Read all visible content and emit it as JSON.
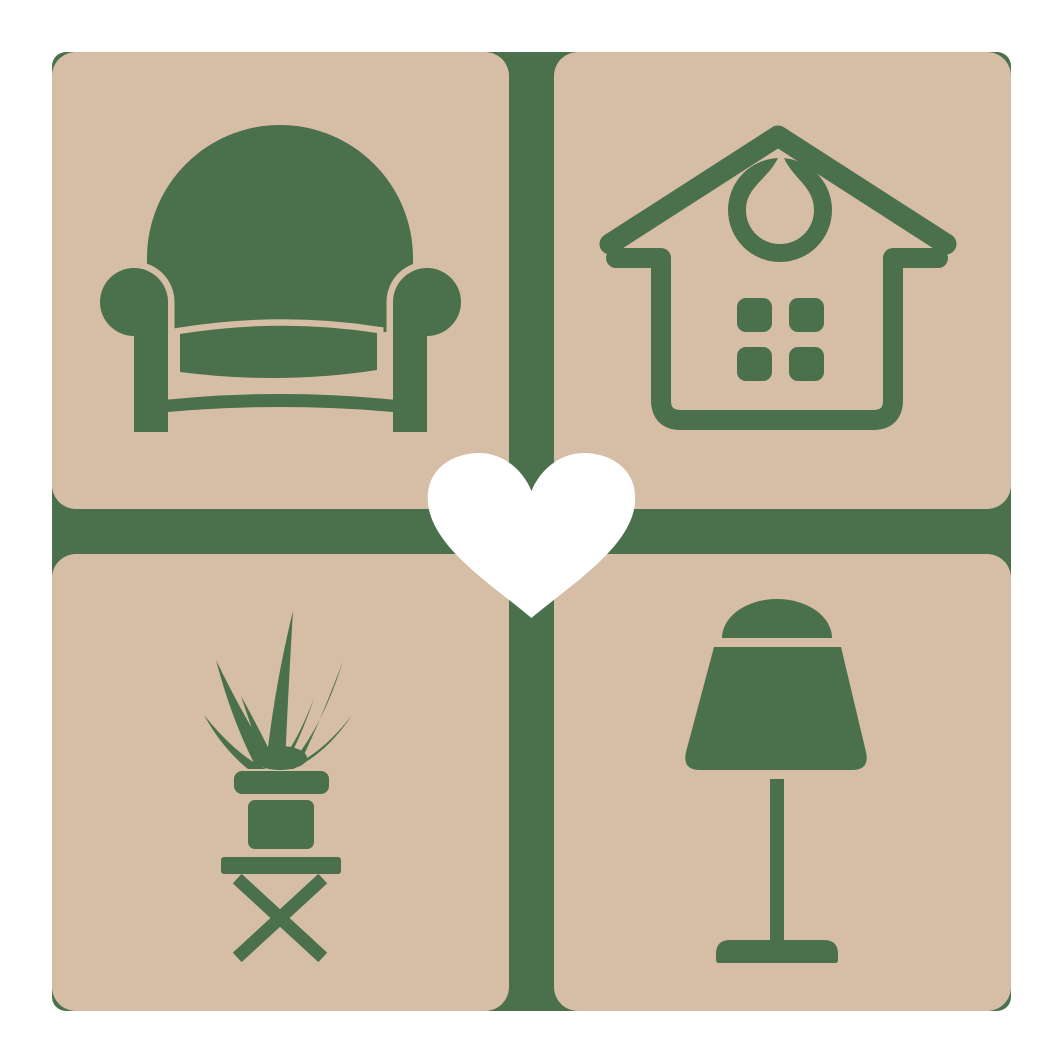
{
  "logo": {
    "description": "Home and furniture love logo: four beige rounded tiles on a green backing square with a white heart at the center",
    "tiles": [
      {
        "position": "top-left",
        "icon": "armchair"
      },
      {
        "position": "top-right",
        "icon": "house-with-hanging-ornament"
      },
      {
        "position": "bottom-left",
        "icon": "potted-plant-on-stool"
      },
      {
        "position": "bottom-right",
        "icon": "table-lamp"
      }
    ],
    "center_icon": "heart"
  },
  "colors": {
    "background": "#ffffff",
    "tile_beige": "#D5BDA6",
    "icon_green": "#4A714C",
    "heart_white": "#ffffff"
  }
}
